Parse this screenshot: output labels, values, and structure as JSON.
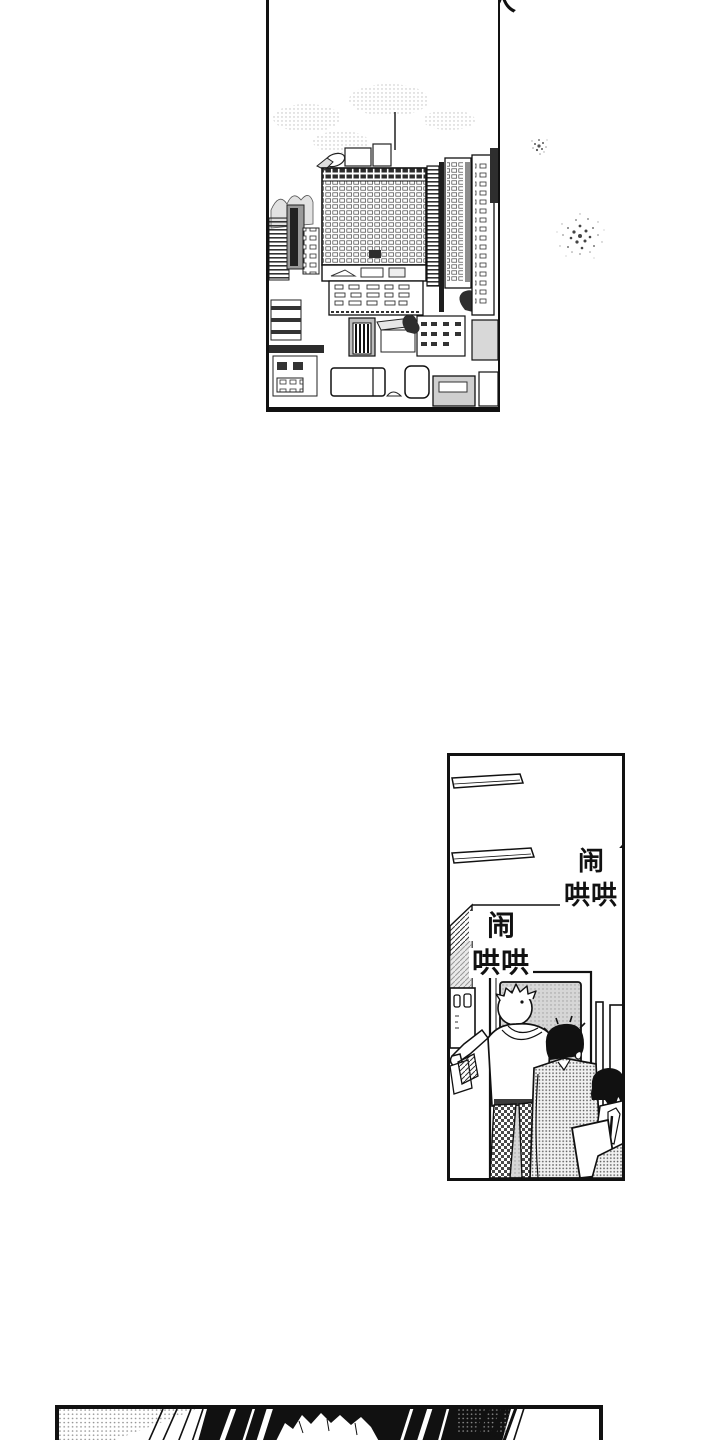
{
  "page": {
    "bg": "#ffffff",
    "ink": "#141414",
    "tone_gray": "#cfcfcf"
  },
  "header": {
    "clipped_title": "确定恋人"
  },
  "panels": {
    "hallway": {
      "sfx": [
        {
          "line1": "闹",
          "line2": "哄哄"
        },
        {
          "line1": "闹",
          "line2": "哄哄"
        }
      ]
    }
  }
}
